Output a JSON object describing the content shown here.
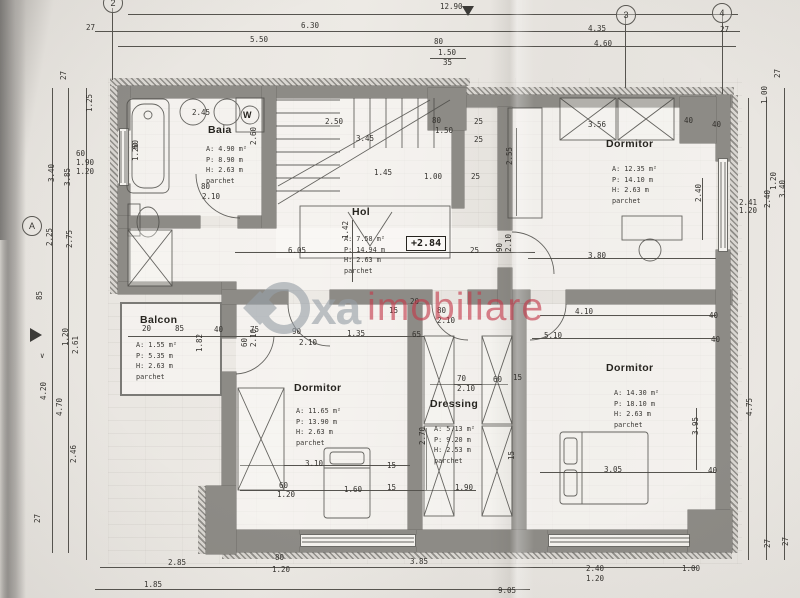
{
  "document_type": "floor-plan",
  "watermark": {
    "logo_text": "oxa",
    "suffix": "imobiliare"
  },
  "level": {
    "value": "+2.84"
  },
  "grid": {
    "top": [
      "2",
      "3",
      "4"
    ],
    "left": [
      "A"
    ]
  },
  "fixtures": {
    "washer": "W"
  },
  "rooms": {
    "baia": {
      "name": "Baia",
      "area": "A: 4.90 m²",
      "perim": "P: 8.90 m",
      "height": "H: 2.63 m",
      "floor": "parchet"
    },
    "hol": {
      "name": "Hol",
      "area": "A: 7.58 m²",
      "perim": "P: 14.94 m",
      "height": "H: 2.63 m",
      "floor": "parchet"
    },
    "dorm1": {
      "name": "Dormitor",
      "area": "A: 12.35 m²",
      "perim": "P: 14.10 m",
      "height": "H: 2.63 m",
      "floor": "parchet"
    },
    "balcon": {
      "name": "Balcon",
      "area": "A: 1.55 m²",
      "perim": "P: 5.35 m",
      "height": "H: 2.63 m",
      "floor": "parchet"
    },
    "dorm2": {
      "name": "Dormitor",
      "area": "A: 11.65 m²",
      "perim": "P: 13.90 m",
      "height": "H: 2.63 m",
      "floor": "parchet"
    },
    "dressing": {
      "name": "Dressing",
      "area": "A: 5.13 m²",
      "perim": "P: 9.20 m",
      "height": "H: 2.53 m",
      "floor": "parchet"
    },
    "dorm3": {
      "name": "Dormitor",
      "area": "A: 14.30 m²",
      "perim": "P: 18.10 m",
      "height": "H: 2.63 m",
      "floor": "parchet"
    }
  },
  "dims": {
    "top": [
      "27",
      "5.50",
      "6.30",
      "12.90",
      "80",
      "1.50",
      "35",
      "4.35",
      "4.60",
      "27"
    ],
    "bottom": [
      "2.85",
      "80",
      "1.20",
      "3.85",
      "1.85",
      "2.40",
      "1.20",
      "1.00",
      "9.05",
      "27"
    ],
    "left": [
      "27",
      "1.25",
      "60",
      "1.90",
      "1.20",
      "3.40",
      "3.85",
      "2.25",
      "2.75",
      "85",
      "1.20",
      "2.61",
      "4.20",
      "4.70",
      "2.46",
      "27"
    ],
    "right": [
      "27",
      "1.00",
      "2.41",
      "1.20",
      "1.20",
      "3.40",
      "2.40",
      "4.75",
      "27"
    ],
    "inner": [
      "2.45",
      "2.50",
      "3.45",
      "80",
      "2.10",
      "2.60",
      "60",
      "1.20",
      "1.45",
      "1.00",
      "80",
      "1.50",
      "25",
      "25",
      "25",
      "25",
      "2.55",
      "3.56",
      "40",
      "40",
      "2.40",
      "3.80",
      "6.05",
      "1.42",
      "90",
      "2.10",
      "20",
      "15",
      "80",
      "2.10",
      "20",
      "85",
      "40",
      "75",
      "90",
      "2.10",
      "1.35",
      "65",
      "5.10",
      "4.10",
      "40",
      "40",
      "60",
      "2.10",
      "3.10",
      "60",
      "1.20",
      "1.60",
      "15",
      "15",
      "1.90",
      "70",
      "2.10",
      "60",
      "15",
      "2.70",
      "15",
      "3.05",
      "40",
      "3.95",
      "1.82"
    ]
  },
  "colors": {
    "wall": "#8d8b86",
    "line": "#4d4c48",
    "watermark_gray": "#98a0a8",
    "watermark_red": "#c4394a",
    "paper": "#eae7e2"
  }
}
